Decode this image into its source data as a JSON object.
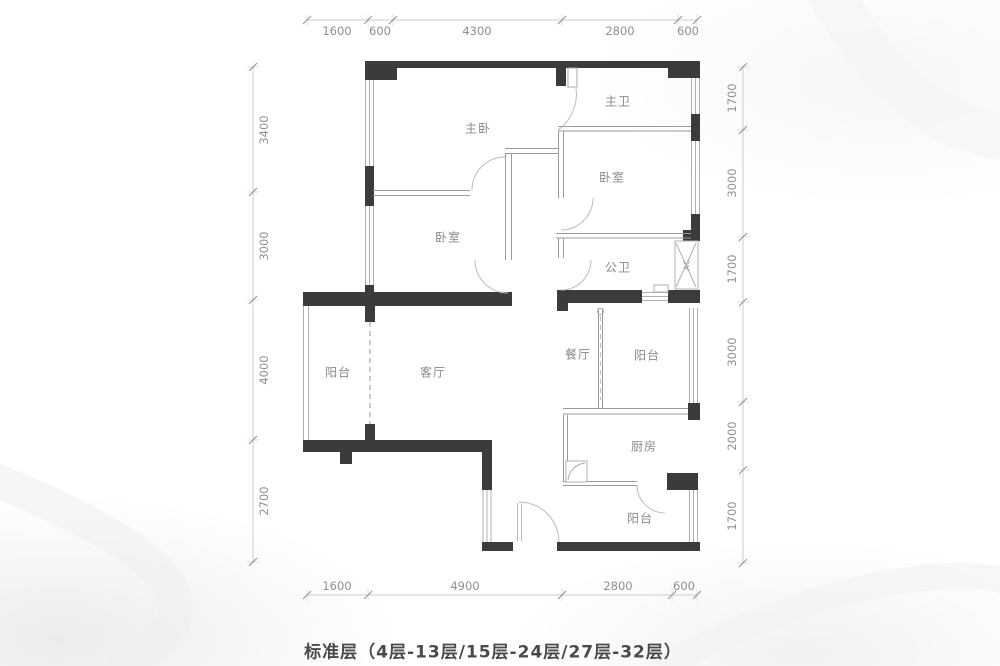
{
  "caption": "标准层（4层-13层/15层-24层/27层-32层）",
  "rooms": {
    "master_bedroom": "主卧",
    "master_bath": "主卫",
    "bedroom_right": "卧室",
    "bedroom_left": "卧室",
    "common_bath": "公卫",
    "balcony_left": "阳台",
    "living_room": "客厅",
    "dining_room": "餐厅",
    "balcony_mid": "阳台",
    "kitchen": "厨房",
    "balcony_bottom": "阳台",
    "ac_unit": "AC"
  },
  "dimensions": {
    "top": [
      "1600",
      "600",
      "4300",
      "2800",
      "600"
    ],
    "bottom": [
      "1600",
      "4900",
      "2800",
      "600"
    ],
    "left": [
      "3400",
      "3000",
      "4000",
      "2700"
    ],
    "right": [
      "1700",
      "3000",
      "1700",
      "3000",
      "2000",
      "1700"
    ]
  },
  "colors": {
    "wall": "#3b3b3b",
    "thin_line": "#b0b0b0",
    "room_label": "#8a8a8a",
    "dim_text": "#8f8f8f",
    "caption_text": "#4a4a4a"
  }
}
